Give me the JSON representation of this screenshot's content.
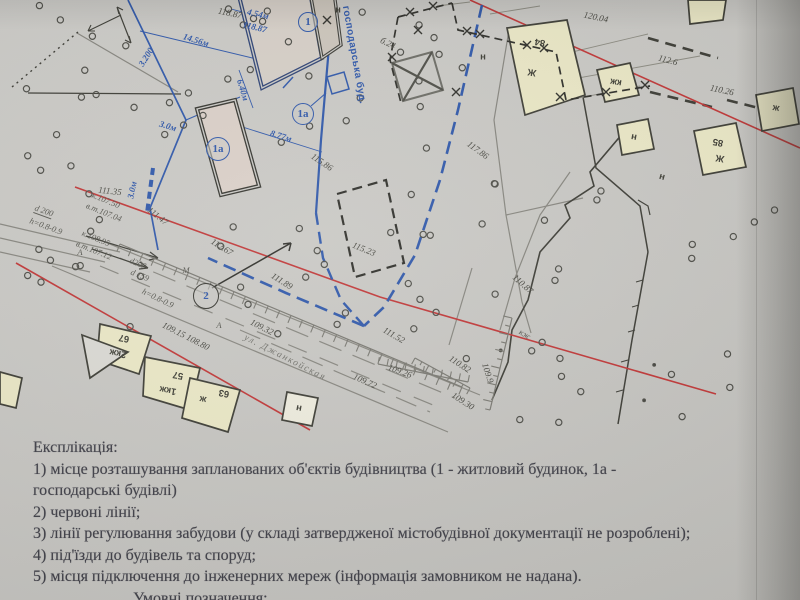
{
  "document": {
    "explication": {
      "title": "Експлікація:",
      "lines": [
        "1) місце розташування запланованих об'єктів будівництва (1 - житловий будинок, 1а -",
        "господарські будівлі)",
        "2) червоні лінії;",
        "3) лінії регулювання забудови (у складі затвердженої містобудівної документації не розроблені);",
        "4) під'їзди до будівель та споруд;",
        "5) місця підключення до інженерних мереж (інформація замовником не надана)."
      ],
      "legend_title": "Умовні позначення:"
    }
  },
  "map": {
    "street_label": {
      "t": "ул. Джанкойская",
      "x": 285,
      "y": 358,
      "rot": 27
    },
    "outbuilding_note": {
      "t": "господарська буд.",
      "x": 354,
      "y": 55,
      "rot": 80
    },
    "circled_marks": [
      {
        "t": "1",
        "x": 308,
        "y": 22,
        "d": 20,
        "black": false
      },
      {
        "t": "1а",
        "x": 218,
        "y": 149,
        "d": 24,
        "black": false
      },
      {
        "t": "1а",
        "x": 303,
        "y": 114,
        "d": 22,
        "black": false
      },
      {
        "t": "2",
        "x": 206,
        "y": 296,
        "d": 26,
        "black": true
      }
    ],
    "elevations": [
      {
        "t": "118.87",
        "x": 230,
        "y": 13,
        "rot": 12
      },
      {
        "t": "б.24",
        "x": 388,
        "y": 43,
        "rot": 25
      },
      {
        "t": "120.04",
        "x": 596,
        "y": 17,
        "rot": 12
      },
      {
        "t": "112.6",
        "x": 668,
        "y": 60,
        "rot": 15
      },
      {
        "t": "110.26",
        "x": 722,
        "y": 90,
        "rot": 12
      },
      {
        "t": "117.86",
        "x": 478,
        "y": 150,
        "rot": 36
      },
      {
        "t": "115.86",
        "x": 322,
        "y": 162,
        "rot": 34
      },
      {
        "t": "115.23",
        "x": 364,
        "y": 249,
        "rot": 22
      },
      {
        "t": "111.35",
        "x": 110,
        "y": 191,
        "rot": 6
      },
      {
        "t": "111.47",
        "x": 158,
        "y": 216,
        "rot": 38
      },
      {
        "t": "112.67",
        "x": 222,
        "y": 247,
        "rot": 32
      },
      {
        "t": "111.89",
        "x": 282,
        "y": 281,
        "rot": 32
      },
      {
        "t": "111.52",
        "x": 394,
        "y": 335,
        "rot": 30
      },
      {
        "t": "110.87",
        "x": 523,
        "y": 284,
        "rot": 42
      },
      {
        "t": "110.82",
        "x": 460,
        "y": 364,
        "rot": 33
      },
      {
        "t": "109.9",
        "x": 488,
        "y": 373,
        "rot": 72
      },
      {
        "t": "109.30",
        "x": 463,
        "y": 401,
        "rot": 33
      },
      {
        "t": "109.15 108.80",
        "x": 186,
        "y": 336,
        "rot": 27
      },
      {
        "t": "109.32",
        "x": 262,
        "y": 327,
        "rot": 27
      },
      {
        "t": "109.72",
        "x": 365,
        "y": 381,
        "rot": 24
      },
      {
        "t": "109.26",
        "x": 400,
        "y": 371,
        "rot": 20
      }
    ],
    "blue_dimensions": [
      {
        "t": "14.56м",
        "x": 196,
        "y": 40,
        "rot": 17
      },
      {
        "t": "118.87",
        "x": 255,
        "y": 27,
        "rot": 14
      },
      {
        "t": "4.54м",
        "x": 258,
        "y": 14,
        "rot": 13
      },
      {
        "t": "6.40м",
        "x": 243,
        "y": 90,
        "rot": 73
      },
      {
        "t": "8.77м",
        "x": 281,
        "y": 136,
        "rot": 17
      },
      {
        "t": "3.0м",
        "x": 168,
        "y": 126,
        "rot": 17
      },
      {
        "t": "3.0м",
        "x": 132,
        "y": 190,
        "rot": -78
      },
      {
        "t": "3.200",
        "x": 146,
        "y": 57,
        "rot": -58
      }
    ],
    "utility_notes": [
      {
        "t": "d 200",
        "x": 44,
        "y": 211,
        "rot": 20,
        "u": true
      },
      {
        "t": "h=0.8-0.9",
        "x": 46,
        "y": 226,
        "rot": 20
      },
      {
        "t": "к.107.50",
        "x": 106,
        "y": 200,
        "rot": 22
      },
      {
        "t": "в.т.107.04",
        "x": 104,
        "y": 212,
        "rot": 22
      },
      {
        "t": "к.108.95",
        "x": 96,
        "y": 238,
        "rot": 22
      },
      {
        "t": "в.т.107.12",
        "x": 94,
        "y": 250,
        "rot": 22
      },
      {
        "t": "d200",
        "x": 138,
        "y": 263,
        "rot": 22
      },
      {
        "t": "d 159",
        "x": 140,
        "y": 275,
        "rot": 22
      },
      {
        "t": "А",
        "x": 80,
        "y": 252,
        "rot": 0
      },
      {
        "t": "М",
        "x": 186,
        "y": 270,
        "rot": 0
      },
      {
        "t": "h=0.8-0.9",
        "x": 158,
        "y": 298,
        "rot": 26
      },
      {
        "t": "А",
        "x": 219,
        "y": 325,
        "rot": 0
      },
      {
        "t": "кж",
        "x": 525,
        "y": 334,
        "rot": 30
      }
    ],
    "building_marks": [
      {
        "t": "84",
        "x": 540,
        "y": 42,
        "rot": 190
      },
      {
        "t": "Ж",
        "x": 532,
        "y": 72,
        "rot": 190
      },
      {
        "t": "кж",
        "x": 616,
        "y": 82,
        "rot": 190
      },
      {
        "t": "н",
        "x": 634,
        "y": 137,
        "rot": 190
      },
      {
        "t": "85",
        "x": 718,
        "y": 142,
        "rot": 190
      },
      {
        "t": "Ж",
        "x": 720,
        "y": 158,
        "rot": 190
      },
      {
        "t": "ж",
        "x": 776,
        "y": 108,
        "rot": 190
      },
      {
        "t": "67",
        "x": 124,
        "y": 338,
        "rot": 190
      },
      {
        "t": "2кж",
        "x": 118,
        "y": 353,
        "rot": 190
      },
      {
        "t": "57",
        "x": 178,
        "y": 375,
        "rot": 190
      },
      {
        "t": "1кж",
        "x": 168,
        "y": 390,
        "rot": 190
      },
      {
        "t": "ж",
        "x": 203,
        "y": 399,
        "rot": 190
      },
      {
        "t": "63",
        "x": 224,
        "y": 393,
        "rot": 190
      },
      {
        "t": "н",
        "x": 299,
        "y": 408,
        "rot": 190
      },
      {
        "t": "н",
        "x": 662,
        "y": 177,
        "rot": 15
      },
      {
        "t": "н",
        "x": 338,
        "y": 10,
        "rot": 0
      },
      {
        "t": "н",
        "x": 483,
        "y": 57,
        "rot": 0
      }
    ],
    "colors": {
      "red_line": "#bf3434",
      "blue_ink": "#2c55a8",
      "paper": "#c7c6c2",
      "building_yellow": "#e9e6c4",
      "ink": "#3a3a33"
    }
  }
}
